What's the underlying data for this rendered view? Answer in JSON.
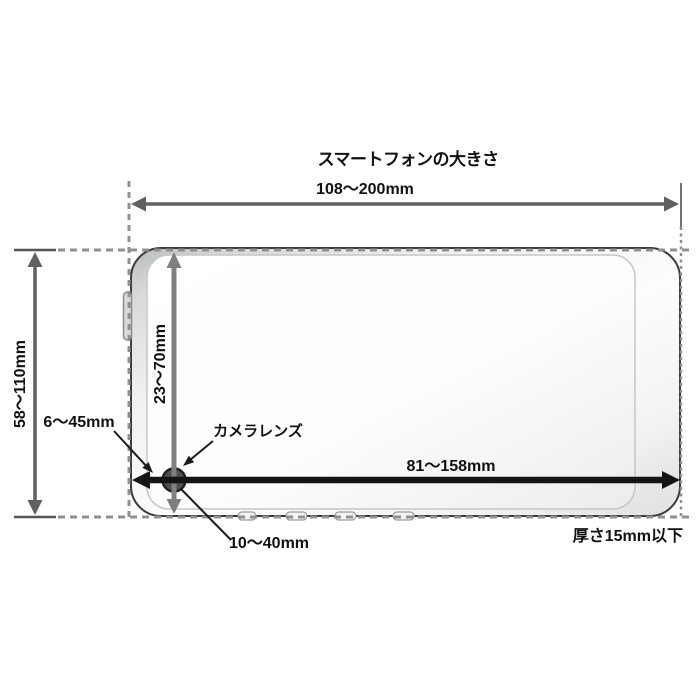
{
  "title": "スマートフォンの大きさ",
  "diagram": {
    "type": "smartphone-size-dimension-diagram",
    "labels": {
      "width": "108〜200mm",
      "height": "58〜110mm",
      "lens_from_top": "23〜70mm",
      "lens_from_left": "6〜45mm",
      "lens_to_right_edge": "81〜158mm",
      "lens_from_bottom": "10〜40mm",
      "camera_lens": "カメラレンズ",
      "thickness": "厚さ15mm以下"
    },
    "colors": {
      "background": "#ffffff",
      "text": "#111111",
      "dimension_arrow_gray": "#606060",
      "lens_arrow_gray": "#7f7f7f",
      "lens_arrow_black": "#141414",
      "dashed_extension_gray": "#909090",
      "phone_outline": "#3b3b3b",
      "lens_fill": "#4e5152"
    }
  }
}
